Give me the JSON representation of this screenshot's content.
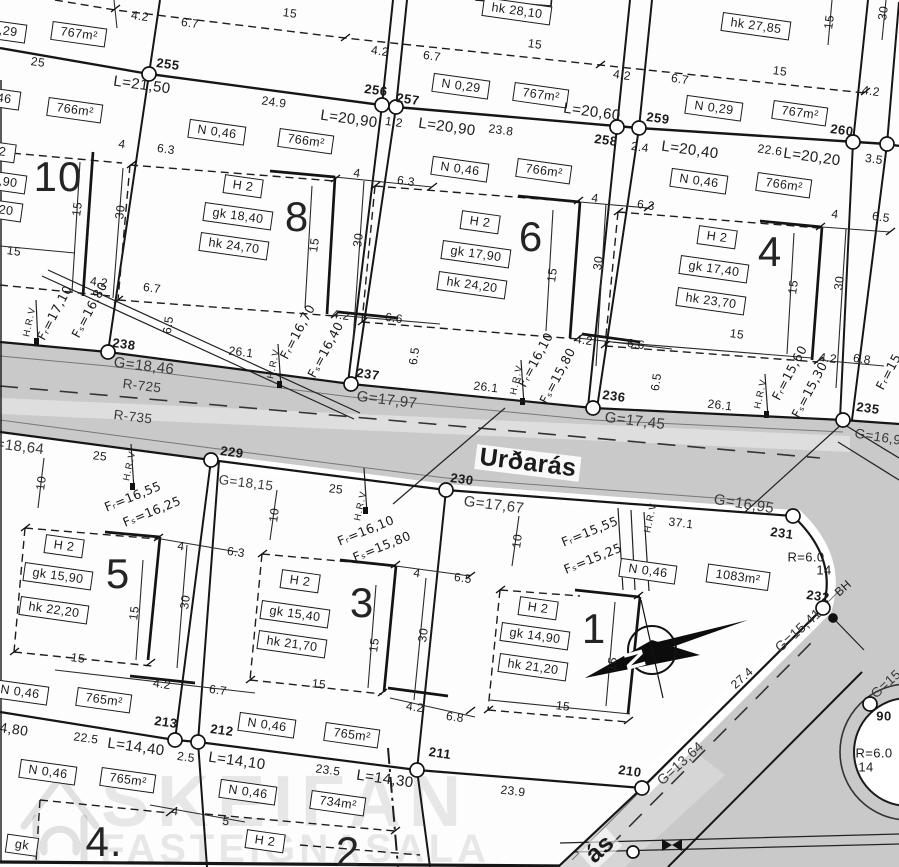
{
  "streets": {
    "main": "Urðarás",
    "secondary": "ás"
  },
  "watermark": {
    "line1": "SKEIFAN",
    "line2": "FASTEIGNASALA"
  },
  "compass": {
    "north": "N"
  },
  "labels": [
    {
      "t": "767m²",
      "x": 79,
      "y": 34,
      "r": 8,
      "b": 1
    },
    {
      "t": "N 0,29",
      "x": -2,
      "y": 30,
      "r": 8,
      "b": 1
    },
    {
      "t": "hk 28,10",
      "x": 517,
      "y": 11,
      "r": 8,
      "b": 1
    },
    {
      "t": "N 0,29",
      "x": 461,
      "y": 86,
      "r": 8,
      "b": 1
    },
    {
      "t": "767m²",
      "x": 541,
      "y": 95,
      "r": 8,
      "b": 1
    },
    {
      "t": "hk 27,85",
      "x": 756,
      "y": 26,
      "r": 8,
      "b": 1
    },
    {
      "t": "N 0,29",
      "x": 714,
      "y": 108,
      "r": 8,
      "b": 1
    },
    {
      "t": "767m²",
      "x": 800,
      "y": 113,
      "r": 8,
      "b": 1
    },
    {
      "t": "N 0,46",
      "x": -8,
      "y": 97,
      "r": 8,
      "b": 1
    },
    {
      "t": "766m²",
      "x": 75,
      "y": 110,
      "r": 8,
      "b": 1
    },
    {
      "t": "H 2",
      "x": -4,
      "y": 151,
      "r": 8,
      "b": 1
    },
    {
      "t": "gk 18,90",
      "x": -8,
      "y": 180,
      "r": 8,
      "b": 1
    },
    {
      "t": "hk 25,20",
      "x": -12,
      "y": 208,
      "r": 8,
      "b": 1
    },
    {
      "t": "N 0,46",
      "x": 217,
      "y": 132,
      "r": 8,
      "b": 1
    },
    {
      "t": "766m²",
      "x": 306,
      "y": 141,
      "r": 8,
      "b": 1
    },
    {
      "t": "H 2",
      "x": 243,
      "y": 186,
      "r": 8,
      "b": 1
    },
    {
      "t": "gk 18,40",
      "x": 238,
      "y": 216,
      "r": 8,
      "b": 1
    },
    {
      "t": "hk 24,70",
      "x": 234,
      "y": 246,
      "r": 8,
      "b": 1
    },
    {
      "t": "N 0,46",
      "x": 460,
      "y": 169,
      "r": 8,
      "b": 1
    },
    {
      "t": "766m²",
      "x": 544,
      "y": 171,
      "r": 8,
      "b": 1
    },
    {
      "t": "H 2",
      "x": 480,
      "y": 222,
      "r": 8,
      "b": 1
    },
    {
      "t": "gk 17,90",
      "x": 476,
      "y": 254,
      "r": 8,
      "b": 1
    },
    {
      "t": "hk 24,20",
      "x": 472,
      "y": 285,
      "r": 8,
      "b": 1
    },
    {
      "t": "N 0,46",
      "x": 699,
      "y": 181,
      "r": 8,
      "b": 1
    },
    {
      "t": "766m²",
      "x": 784,
      "y": 185,
      "r": 8,
      "b": 1
    },
    {
      "t": "H 2",
      "x": 717,
      "y": 237,
      "r": 8,
      "b": 1
    },
    {
      "t": "gk 17,40",
      "x": 714,
      "y": 269,
      "r": 8,
      "b": 1
    },
    {
      "t": "hk 23,70",
      "x": 711,
      "y": 301,
      "r": 8,
      "b": 1
    },
    {
      "t": "H 2",
      "x": 64,
      "y": 546,
      "r": 8,
      "b": 1
    },
    {
      "t": "gk 15,90",
      "x": 58,
      "y": 576,
      "r": 8,
      "b": 1
    },
    {
      "t": "hk 22,20",
      "x": 54,
      "y": 610,
      "r": 8,
      "b": 1
    },
    {
      "t": "H 2",
      "x": 300,
      "y": 581,
      "r": 8,
      "b": 1
    },
    {
      "t": "gk 15,40",
      "x": 295,
      "y": 614,
      "r": 8,
      "b": 1
    },
    {
      "t": "hk 21,70",
      "x": 292,
      "y": 644,
      "r": 8,
      "b": 1
    },
    {
      "t": "H 2",
      "x": 538,
      "y": 608,
      "r": 8,
      "b": 1
    },
    {
      "t": "gk 14,90",
      "x": 535,
      "y": 636,
      "r": 8,
      "b": 1
    },
    {
      "t": "hk 21,20",
      "x": 533,
      "y": 667,
      "r": 8,
      "b": 1
    },
    {
      "t": "N 0,46",
      "x": 648,
      "y": 571,
      "r": 8,
      "b": 1
    },
    {
      "t": "1083m²",
      "x": 738,
      "y": 577,
      "r": 8,
      "b": 1
    },
    {
      "t": "N 0,46",
      "x": 20,
      "y": 692,
      "r": 8,
      "b": 1
    },
    {
      "t": "765m²",
      "x": 104,
      "y": 700,
      "r": 8,
      "b": 1
    },
    {
      "t": "N 0,46",
      "x": 267,
      "y": 725,
      "r": 8,
      "b": 1
    },
    {
      "t": "765m²",
      "x": 352,
      "y": 735,
      "r": 8,
      "b": 1
    },
    {
      "t": "N 0,46",
      "x": 48,
      "y": 772,
      "r": 8,
      "b": 1
    },
    {
      "t": "765m²",
      "x": 128,
      "y": 780,
      "r": 8,
      "b": 1
    },
    {
      "t": "N 0,46",
      "x": 248,
      "y": 792,
      "r": 8,
      "b": 1
    },
    {
      "t": "734m²",
      "x": 338,
      "y": 803,
      "r": 8,
      "b": 1
    },
    {
      "t": "H 2",
      "x": 265,
      "y": 841,
      "r": 8,
      "b": 1
    },
    {
      "t": "gk",
      "x": 22,
      "y": 845,
      "r": 8,
      "b": 1
    },
    {
      "t": "10",
      "x": 58,
      "y": 177,
      "cls": "big",
      "n": "plot-number-10"
    },
    {
      "t": "8",
      "x": 297,
      "y": 217,
      "cls": "big",
      "n": "plot-number-8"
    },
    {
      "t": "6",
      "x": 531,
      "y": 237,
      "cls": "big",
      "n": "plot-number-6"
    },
    {
      "t": "4",
      "x": 770,
      "y": 252,
      "cls": "big",
      "n": "plot-number-4"
    },
    {
      "t": "5",
      "x": 118,
      "y": 574,
      "cls": "big",
      "n": "plot-number-5"
    },
    {
      "t": "3",
      "x": 362,
      "y": 603,
      "cls": "big",
      "n": "plot-number-3"
    },
    {
      "t": "1",
      "x": 594,
      "y": 629,
      "cls": "big",
      "n": "plot-number-1"
    },
    {
      "t": "4.",
      "x": 104,
      "y": 842,
      "cls": "big",
      "n": "plot-number-4b"
    },
    {
      "t": "2",
      "x": 348,
      "y": 852,
      "cls": "big",
      "n": "plot-number-2"
    },
    {
      "t": "255",
      "x": 168,
      "y": 64,
      "r": 8,
      "cls": "pt"
    },
    {
      "t": "256",
      "x": 376,
      "y": 90,
      "r": 8,
      "cls": "pt"
    },
    {
      "t": "257",
      "x": 408,
      "y": 99,
      "r": 8,
      "cls": "pt"
    },
    {
      "t": "258",
      "x": 606,
      "y": 140,
      "r": 8,
      "cls": "pt"
    },
    {
      "t": "259",
      "x": 658,
      "y": 118,
      "r": 8,
      "cls": "pt"
    },
    {
      "t": "260",
      "x": 842,
      "y": 130,
      "r": 8,
      "cls": "pt"
    },
    {
      "t": "238",
      "x": 124,
      "y": 344,
      "r": 8,
      "cls": "pt"
    },
    {
      "t": "237",
      "x": 368,
      "y": 374,
      "r": 8,
      "cls": "pt"
    },
    {
      "t": "236",
      "x": 614,
      "y": 396,
      "r": 8,
      "cls": "pt"
    },
    {
      "t": "235",
      "x": 868,
      "y": 408,
      "r": 8,
      "cls": "pt"
    },
    {
      "t": "229",
      "x": 232,
      "y": 452,
      "r": 8,
      "cls": "pt"
    },
    {
      "t": "230",
      "x": 462,
      "y": 479,
      "r": 8,
      "cls": "pt"
    },
    {
      "t": "231",
      "x": 782,
      "y": 533,
      "r": 8,
      "cls": "pt"
    },
    {
      "t": "232",
      "x": 818,
      "y": 596,
      "r": 8,
      "cls": "pt"
    },
    {
      "t": "213",
      "x": 166,
      "y": 722,
      "r": 8,
      "cls": "pt"
    },
    {
      "t": "212",
      "x": 222,
      "y": 730,
      "r": 8,
      "cls": "pt"
    },
    {
      "t": "211",
      "x": 440,
      "y": 753,
      "r": 8,
      "cls": "pt"
    },
    {
      "t": "210",
      "x": 630,
      "y": 771,
      "r": 8,
      "cls": "pt"
    },
    {
      "t": "90",
      "x": 884,
      "y": 716,
      "cls": "pt"
    },
    {
      "t": "25",
      "x": 38,
      "y": 62,
      "r": 8
    },
    {
      "t": "L=21,50",
      "x": 142,
      "y": 85,
      "r": 8,
      "s": 15
    },
    {
      "t": "24.9",
      "x": 274,
      "y": 102,
      "r": 8
    },
    {
      "t": "L=20,90",
      "x": 349,
      "y": 119,
      "r": 8,
      "s": 15
    },
    {
      "t": "1.2",
      "x": 394,
      "y": 122,
      "r": 8
    },
    {
      "t": "L=20,90",
      "x": 447,
      "y": 127,
      "r": 8,
      "s": 15
    },
    {
      "t": "23.8",
      "x": 501,
      "y": 130,
      "r": 8
    },
    {
      "t": "L=20,60",
      "x": 592,
      "y": 112,
      "r": 8,
      "s": 15
    },
    {
      "t": "2.4",
      "x": 640,
      "y": 147,
      "r": 8
    },
    {
      "t": "L=20,40",
      "x": 690,
      "y": 150,
      "r": 8,
      "s": 15
    },
    {
      "t": "22.6",
      "x": 770,
      "y": 150,
      "r": 8
    },
    {
      "t": "L=20,20",
      "x": 812,
      "y": 157,
      "r": 8,
      "s": 15
    },
    {
      "t": "3.5",
      "x": 874,
      "y": 159,
      "r": 8
    },
    {
      "t": "4,80",
      "x": 14,
      "y": 729,
      "r": 8,
      "s": 14
    },
    {
      "t": "22.5",
      "x": 86,
      "y": 738,
      "r": 8
    },
    {
      "t": "L=14,40",
      "x": 136,
      "y": 747,
      "r": 8,
      "s": 15
    },
    {
      "t": "2.5",
      "x": 186,
      "y": 757,
      "r": 8
    },
    {
      "t": "L=14,10",
      "x": 237,
      "y": 761,
      "r": 8,
      "s": 15
    },
    {
      "t": "23.5",
      "x": 328,
      "y": 770,
      "r": 8
    },
    {
      "t": "L=14,30",
      "x": 385,
      "y": 779,
      "r": 8,
      "s": 15
    },
    {
      "t": "23.9",
      "x": 513,
      "y": 791,
      "r": 7
    },
    {
      "t": "G=18,46",
      "x": 144,
      "y": 366,
      "r": 7,
      "cls": "g",
      "s": 15
    },
    {
      "t": "R-725",
      "x": 142,
      "y": 386,
      "r": 7,
      "cls": "g"
    },
    {
      "t": "R-735",
      "x": 133,
      "y": 417,
      "r": 7,
      "cls": "g"
    },
    {
      "t": "G=17,97",
      "x": 387,
      "y": 400,
      "r": 7,
      "cls": "g",
      "s": 15
    },
    {
      "t": "G=17,45",
      "x": 635,
      "y": 421,
      "r": 7,
      "cls": "g",
      "s": 15
    },
    {
      "t": "G=18,64",
      "x": 14,
      "y": 446,
      "r": 7,
      "cls": "g",
      "s": 15
    },
    {
      "t": "G=18,15",
      "x": 246,
      "y": 483,
      "r": 7,
      "cls": "g"
    },
    {
      "t": "G=17,67",
      "x": 494,
      "y": 505,
      "r": 7,
      "cls": "g",
      "s": 15
    },
    {
      "t": "G=16,95",
      "x": 744,
      "y": 504,
      "r": 9,
      "cls": "g",
      "s": 15
    },
    {
      "t": "G=15,41",
      "x": 798,
      "y": 630,
      "r": -42,
      "cls": "g",
      "s": 14
    },
    {
      "t": "G=13,64",
      "x": 680,
      "y": 763,
      "r": -42,
      "cls": "g",
      "s": 14
    },
    {
      "t": "G=16,9",
      "x": 878,
      "y": 437,
      "r": 9,
      "cls": "g"
    },
    {
      "t": "G=15",
      "x": 886,
      "y": 684,
      "r": -42,
      "cls": "g"
    },
    {
      "t": "R=6.0",
      "x": 806,
      "y": 557,
      "s": 13
    },
    {
      "t": "14",
      "x": 824,
      "y": 570,
      "s": 13
    },
    {
      "t": "R=6.0",
      "x": 874,
      "y": 753,
      "s": 13
    },
    {
      "t": "14",
      "x": 866,
      "y": 767,
      "s": 13
    },
    {
      "t": "BH",
      "x": 843,
      "y": 588,
      "r": -42,
      "s": 12
    },
    {
      "t": "Fᵣ=17,10",
      "x": 55,
      "y": 313,
      "r": -62,
      "cls": "f"
    },
    {
      "t": "Fₛ=16,80",
      "x": 90,
      "y": 310,
      "r": -62,
      "cls": "f"
    },
    {
      "t": "Fᵣ=16,70",
      "x": 298,
      "y": 332,
      "r": -62,
      "cls": "f"
    },
    {
      "t": "Fₛ=16,40",
      "x": 326,
      "y": 350,
      "r": -62,
      "cls": "f"
    },
    {
      "t": "Fᵣ=16,10",
      "x": 536,
      "y": 360,
      "r": -62,
      "cls": "f"
    },
    {
      "t": "Fₛ=15,80",
      "x": 558,
      "y": 376,
      "r": -62,
      "cls": "f"
    },
    {
      "t": "Fᵣ=15,60",
      "x": 790,
      "y": 373,
      "r": -62,
      "cls": "f"
    },
    {
      "t": "Fₛ=15,30",
      "x": 810,
      "y": 390,
      "r": -62,
      "cls": "f"
    },
    {
      "t": "Fᵣ=15,",
      "x": 890,
      "y": 370,
      "r": -62,
      "cls": "f"
    },
    {
      "t": "Fᵣ=16,55",
      "x": 133,
      "y": 497,
      "r": -22,
      "cls": "f"
    },
    {
      "t": "Fₛ=16,25",
      "x": 152,
      "y": 512,
      "r": -22,
      "cls": "f"
    },
    {
      "t": "Fᵣ=16,10",
      "x": 366,
      "y": 531,
      "r": -22,
      "cls": "f"
    },
    {
      "t": "Fₛ=15,80",
      "x": 382,
      "y": 547,
      "r": -22,
      "cls": "f"
    },
    {
      "t": "Fᵣ=15,55",
      "x": 590,
      "y": 532,
      "r": -22,
      "cls": "f"
    },
    {
      "t": "Fₛ=15,25",
      "x": 593,
      "y": 559,
      "r": -22,
      "cls": "f"
    },
    {
      "t": "H.R.V",
      "x": 30,
      "y": 322,
      "r": -78,
      "cls": "hrv"
    },
    {
      "t": "H.R.V",
      "x": 274,
      "y": 364,
      "r": -78,
      "cls": "hrv"
    },
    {
      "t": "H.R.V",
      "x": 517,
      "y": 380,
      "r": -78,
      "cls": "hrv"
    },
    {
      "t": "H.R.V",
      "x": 761,
      "y": 394,
      "r": -78,
      "cls": "hrv"
    },
    {
      "t": "H.R.V",
      "x": 130,
      "y": 466,
      "r": -78,
      "cls": "hrv"
    },
    {
      "t": "H.R.V",
      "x": 361,
      "y": 506,
      "r": -78,
      "cls": "hrv"
    },
    {
      "t": "H.R.V",
      "x": 651,
      "y": 518,
      "r": -78,
      "cls": "hrv"
    },
    {
      "t": "4.2",
      "x": 140,
      "y": 16,
      "r": 8
    },
    {
      "t": "6.7",
      "x": 190,
      "y": 23,
      "r": 8
    },
    {
      "t": "15",
      "x": 290,
      "y": 13,
      "r": 8
    },
    {
      "t": "4.2",
      "x": 380,
      "y": 51,
      "r": 8
    },
    {
      "t": "6.7",
      "x": 432,
      "y": 56,
      "r": 8
    },
    {
      "t": "15",
      "x": 535,
      "y": 44,
      "r": 8
    },
    {
      "t": "4.2",
      "x": 622,
      "y": 75,
      "r": 8
    },
    {
      "t": "6.7",
      "x": 680,
      "y": 79,
      "r": 8
    },
    {
      "t": "15",
      "x": 780,
      "y": 71,
      "r": 8
    },
    {
      "t": "4.2",
      "x": 871,
      "y": 91,
      "r": 8
    },
    {
      "t": "15",
      "x": 829,
      "y": 22,
      "r": -82
    },
    {
      "t": "30",
      "x": 883,
      "y": 13,
      "r": -82
    },
    {
      "t": "4",
      "x": 122,
      "y": 144,
      "r": 8
    },
    {
      "t": "15",
      "x": 77,
      "y": 209,
      "r": -82
    },
    {
      "t": "30",
      "x": 120,
      "y": 212,
      "r": -82
    },
    {
      "t": "15",
      "x": 14,
      "y": 251,
      "r": 8
    },
    {
      "t": "4.2",
      "x": 99,
      "y": 282,
      "r": 8
    },
    {
      "t": "6.7",
      "x": 152,
      "y": 288,
      "r": 8
    },
    {
      "t": "6.3",
      "x": 166,
      "y": 149,
      "r": 8
    },
    {
      "t": "4",
      "x": 357,
      "y": 173,
      "r": 8
    },
    {
      "t": "6.3",
      "x": 406,
      "y": 181,
      "r": 8
    },
    {
      "t": "15",
      "x": 314,
      "y": 245,
      "r": -82
    },
    {
      "t": "30",
      "x": 358,
      "y": 240,
      "r": -82
    },
    {
      "t": "4.2",
      "x": 341,
      "y": 315,
      "r": 8
    },
    {
      "t": "6.6",
      "x": 394,
      "y": 318,
      "r": 8
    },
    {
      "t": "6.5",
      "x": 168,
      "y": 325,
      "r": -82
    },
    {
      "t": "26.1",
      "x": 241,
      "y": 352,
      "r": 7
    },
    {
      "t": "4",
      "x": 595,
      "y": 198,
      "r": 8
    },
    {
      "t": "6.3",
      "x": 646,
      "y": 205,
      "r": 8
    },
    {
      "t": "15",
      "x": 552,
      "y": 275,
      "r": -82
    },
    {
      "t": "30",
      "x": 598,
      "y": 263,
      "r": -82
    },
    {
      "t": "4.2",
      "x": 584,
      "y": 340,
      "r": 8
    },
    {
      "t": "6.6",
      "x": 636,
      "y": 344,
      "r": 8
    },
    {
      "t": "6.5",
      "x": 414,
      "y": 356,
      "r": -82
    },
    {
      "t": "26.1",
      "x": 486,
      "y": 387,
      "r": 7
    },
    {
      "t": "4",
      "x": 835,
      "y": 214,
      "r": 8
    },
    {
      "t": "6.5",
      "x": 881,
      "y": 217,
      "r": 8
    },
    {
      "t": "15",
      "x": 793,
      "y": 287,
      "r": -82
    },
    {
      "t": "30",
      "x": 839,
      "y": 283,
      "r": -82
    },
    {
      "t": "15",
      "x": 737,
      "y": 334,
      "r": 8
    },
    {
      "t": "4.2",
      "x": 828,
      "y": 358,
      "r": 8
    },
    {
      "t": "6.8",
      "x": 862,
      "y": 359,
      "r": 8
    },
    {
      "t": "6.5",
      "x": 656,
      "y": 382,
      "r": -82
    },
    {
      "t": "26.1",
      "x": 720,
      "y": 405,
      "r": 7
    },
    {
      "t": "25",
      "x": 100,
      "y": 456,
      "r": 7
    },
    {
      "t": "10",
      "x": 41,
      "y": 483,
      "r": -82
    },
    {
      "t": "25",
      "x": 336,
      "y": 489,
      "r": 7
    },
    {
      "t": "10",
      "x": 274,
      "y": 515,
      "r": -82
    },
    {
      "t": "10",
      "x": 517,
      "y": 541,
      "r": -82
    },
    {
      "t": "37.1",
      "x": 681,
      "y": 523,
      "r": 7
    },
    {
      "t": "4",
      "x": 181,
      "y": 546,
      "r": 8
    },
    {
      "t": "6.3",
      "x": 236,
      "y": 552,
      "r": 8
    },
    {
      "t": "4",
      "x": 417,
      "y": 573,
      "r": 8
    },
    {
      "t": "6.5",
      "x": 463,
      "y": 578,
      "r": 8
    },
    {
      "t": "15",
      "x": 134,
      "y": 613,
      "r": -82
    },
    {
      "t": "30",
      "x": 185,
      "y": 602,
      "r": -82
    },
    {
      "t": "15",
      "x": 374,
      "y": 645,
      "r": -82
    },
    {
      "t": "30",
      "x": 423,
      "y": 635,
      "r": -82
    },
    {
      "t": "15",
      "x": 612,
      "y": 664,
      "r": -82
    },
    {
      "t": "15",
      "x": 78,
      "y": 658,
      "r": 8
    },
    {
      "t": "15",
      "x": 319,
      "y": 684,
      "r": 7
    },
    {
      "t": "15",
      "x": 563,
      "y": 706,
      "r": 7
    },
    {
      "t": "4.2",
      "x": 162,
      "y": 684,
      "r": 8
    },
    {
      "t": "6.7",
      "x": 218,
      "y": 690,
      "r": 8
    },
    {
      "t": "4.2",
      "x": 415,
      "y": 707,
      "r": 8
    },
    {
      "t": "6.8",
      "x": 455,
      "y": 717,
      "r": 8
    },
    {
      "t": "27.4",
      "x": 742,
      "y": 678,
      "r": -42
    },
    {
      "t": "4",
      "x": 175,
      "y": 811,
      "r": 8
    },
    {
      "t": "5",
      "x": 226,
      "y": 821,
      "r": 8
    }
  ]
}
